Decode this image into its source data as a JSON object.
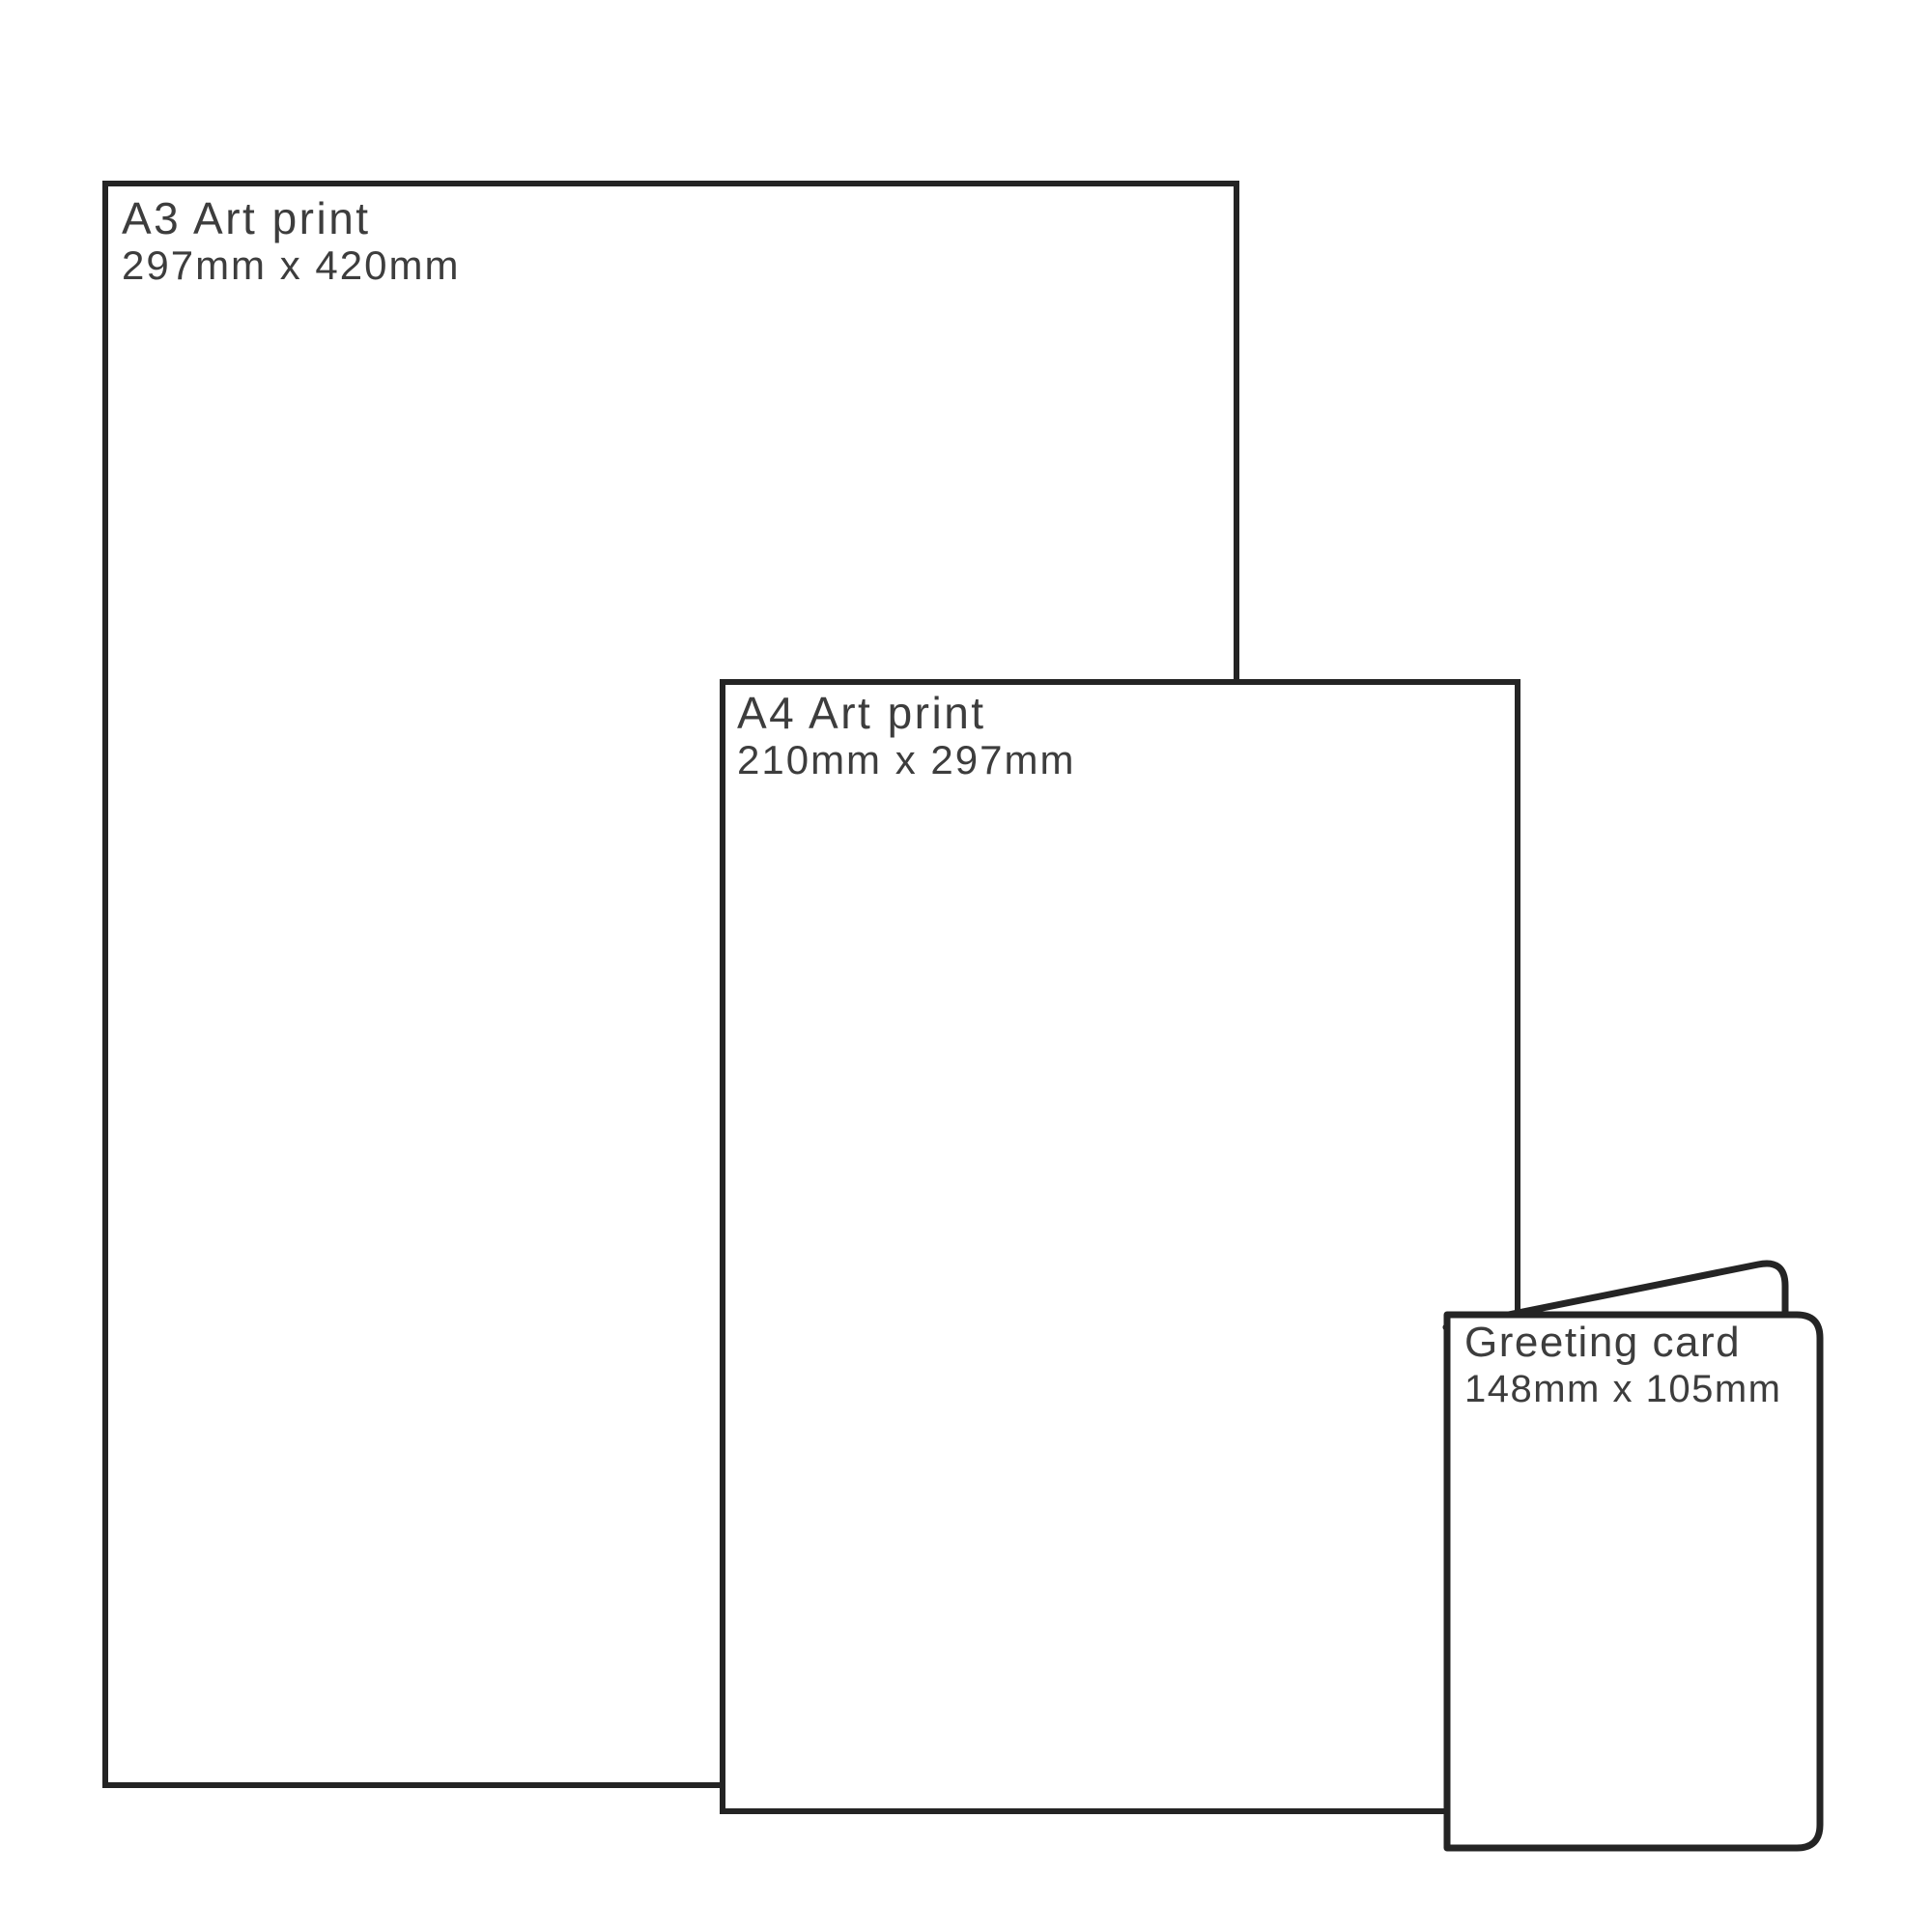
{
  "diagram": {
    "description": "Print size comparison diagram",
    "items": [
      {
        "id": "a3-art-print",
        "title": "A3 Art print",
        "dimensions": "297mm x 420mm"
      },
      {
        "id": "a4-art-print",
        "title": "A4 Art print",
        "dimensions": "210mm x 297mm"
      },
      {
        "id": "greeting-card",
        "title": "Greeting card",
        "dimensions": "148mm x 105mm"
      }
    ],
    "colors": {
      "outline": "#242424",
      "text": "#3d3d3d",
      "background": "#ffffff"
    }
  }
}
